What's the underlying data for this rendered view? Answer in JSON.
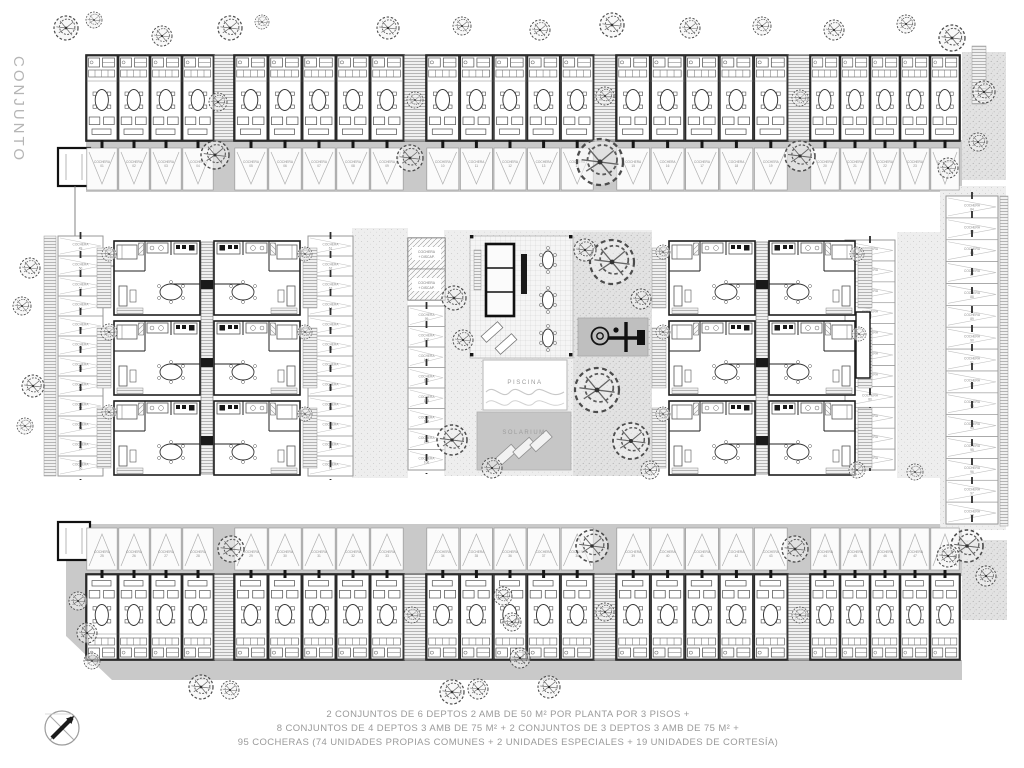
{
  "site_title_vertical": "CONJUNTO",
  "caption": {
    "line1": "2 CONJUNTOS DE 6 DEPTOS 2 AMB DE 50 M² POR PLANTA POR 3 PISOS +",
    "line2": "8 CONJUNTOS DE 4 DEPTOS 3 AMB DE 75 M² + 2 CONJUNTOS DE 3 DEPTOS 3 AMB DE 75 M² +",
    "line3": "95 COCHERAS (74 UNIDADES PROPIAS COMUNES + 2 UNIDADES ESPECIALES + 19 UNIDADES DE CORTESÍA)"
  },
  "labels": {
    "pool": "PISCINA",
    "solarium": "SOLARIUM",
    "stall": "COCHERA",
    "special_stall_line1": "COCHERA",
    "special_stall_line2": "+ DISCAP."
  },
  "summary": {
    "total_cocheras": "95",
    "unidades_propias_comunes": "74",
    "unidades_especiales": "2",
    "unidades_cortesia": "19"
  }
}
